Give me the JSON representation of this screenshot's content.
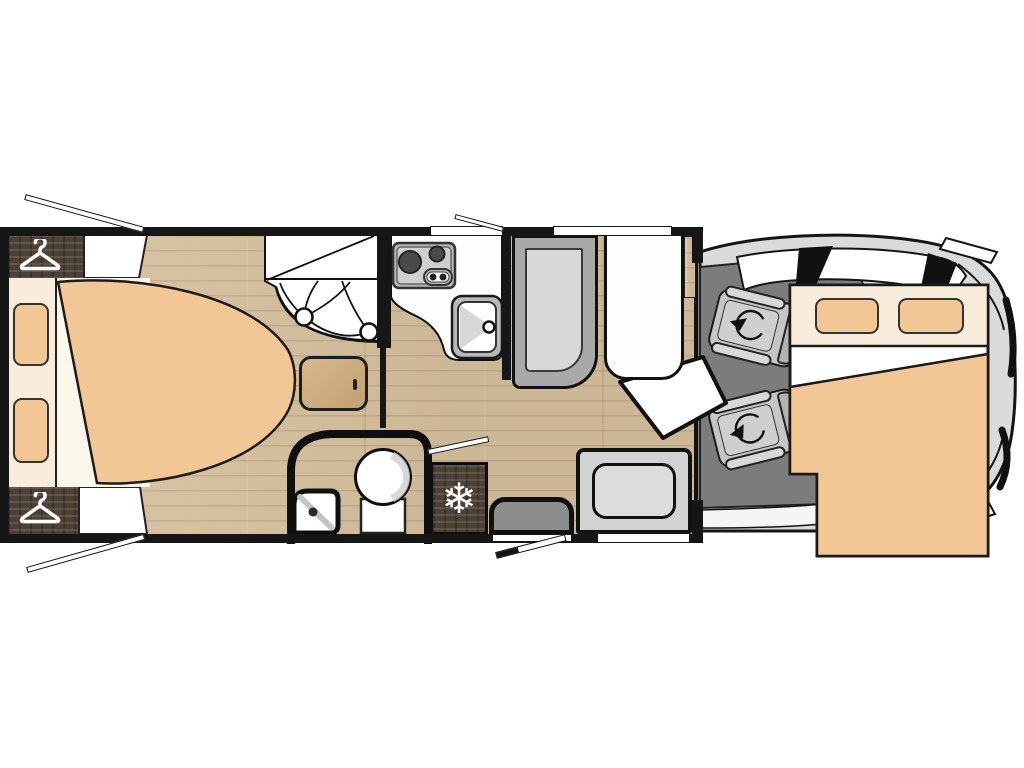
{
  "title": "Motorhome floor plan (top view)",
  "icons": {
    "snowflake": "❄",
    "hanger": "clothes-hanger-icon",
    "swivel": "rotation-arrow-icon"
  },
  "colors": {
    "wall": "#161616",
    "floor_wood": "#d7c19e",
    "dark_wood": "#4c4136",
    "fabric": "#f3c795",
    "cream": "#f8ecdb",
    "cab_shell": "#dbdbdb",
    "cab_floor": "#7c7c7c",
    "seat_gray": "#c6c6c6",
    "unit_gray": "#a9a9a9",
    "unit_inner": "#d8d8d8",
    "step_gray": "#8d8d8d",
    "counter": "#fdfdfd",
    "steel": "#b9b9b9"
  },
  "plan": {
    "vehicle": "motorhome",
    "view": "top-down floor plan",
    "zones": {
      "rear_bedroom": {
        "bed": "island-bed",
        "pillows": 2,
        "wardrobes": [
          "rear-top-left",
          "rear-bottom-left"
        ],
        "nightstand": 1
      },
      "washroom": {
        "shower": "corner-shower-with-curtain",
        "toilet": 1,
        "corner_washbasin": 1
      },
      "kitchen": {
        "hob_burners": 2,
        "hob_control_knobs": 2,
        "sink": 1
      },
      "lounge": {
        "sofa_gray": 1,
        "seat_white": 1,
        "table": 1,
        "travel_bench": 1
      },
      "entrance": {
        "door_state": "open",
        "entry_step": 1
      },
      "appliances": {
        "fridge": "marked-with-snowflake"
      },
      "cab": {
        "swivel_seats": 2,
        "drop_down_bed": {
          "pillows": 2
        }
      }
    },
    "open_windows": 3
  }
}
